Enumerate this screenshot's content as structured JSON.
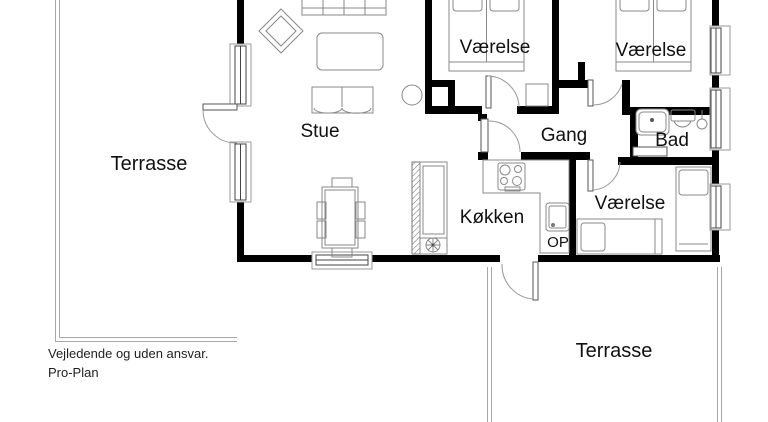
{
  "page": {
    "background": "#ffffff"
  },
  "plan": {
    "colors": {
      "wall": "#000000",
      "window_frame": "#444444",
      "furniture_line": "#888888",
      "terrace_outline": "#a8a8a8",
      "label_text": "#111111"
    },
    "labels": {
      "terrace_left": "Terrasse",
      "living_room": "Stue",
      "bedroom_top_left": "Værelse",
      "bedroom_top_right": "Værelse",
      "hallway": "Gang",
      "bathroom": "Bad",
      "kitchen": "Køkken",
      "bedroom_bottom": "Værelse",
      "stairs_up": "OP",
      "terrace_bottom": "Terrasse"
    },
    "footer": {
      "disclaimer": "Vejledende og uden ansvar.",
      "brand": "Pro-Plan"
    }
  }
}
